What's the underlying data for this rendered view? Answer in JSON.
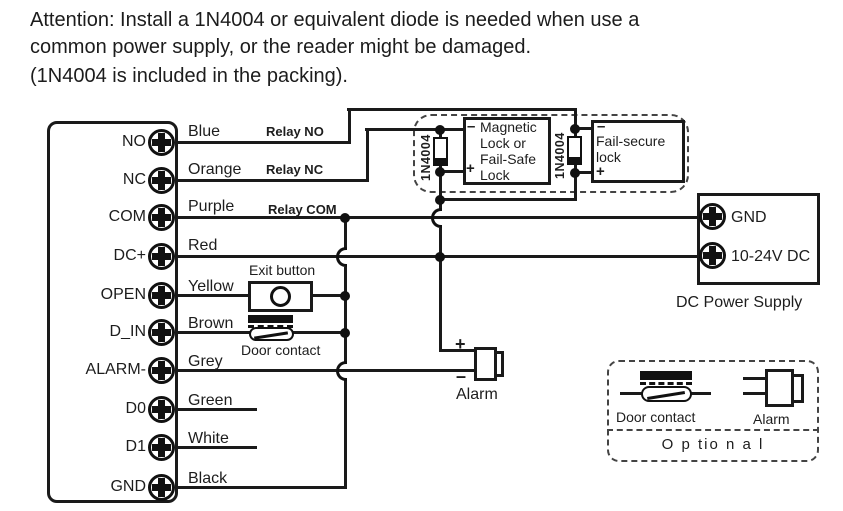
{
  "attention": {
    "line1": "Attention: Install a 1N4004 or equivalent diode is needed when use  a",
    "line2": "common power supply, or the reader might be damaged.",
    "line3": "(1N4004 is included in the packing)."
  },
  "reader": {
    "terminals": [
      {
        "label": "NO",
        "wire": "Blue",
        "relay": "Relay NO"
      },
      {
        "label": "NC",
        "wire": "Orange",
        "relay": "Relay NC"
      },
      {
        "label": "COM",
        "wire": "Purple",
        "relay": "Relay COM"
      },
      {
        "label": "DC+",
        "wire": "Red"
      },
      {
        "label": "OPEN",
        "wire": "Yellow"
      },
      {
        "label": "D_IN",
        "wire": "Brown"
      },
      {
        "label": "ALARM-",
        "wire": "Grey"
      },
      {
        "label": "D0",
        "wire": "Green"
      },
      {
        "label": "D1",
        "wire": "White"
      },
      {
        "label": "GND",
        "wire": "Black"
      }
    ]
  },
  "locks": {
    "diode1": "1N4004",
    "diode2": "1N4004",
    "magnetic": {
      "minus": "–",
      "plus": "+",
      "line1": "Magnetic",
      "line2": "Lock or",
      "line3": "Fail-Safe",
      "line4": "Lock"
    },
    "fail_secure": {
      "minus": "–",
      "plus": "+",
      "line1": "Fail-secure",
      "line2": "lock"
    }
  },
  "exit_button": {
    "label": "Exit button"
  },
  "door_contact": {
    "label": "Door contact"
  },
  "alarm": {
    "label": "Alarm",
    "plus": "+",
    "minus": "–"
  },
  "power_supply": {
    "terminal1": "GND",
    "terminal2": "10-24V DC",
    "label": "DC Power Supply"
  },
  "optional": {
    "door_contact": "Door contact",
    "alarm": "Alarm",
    "label": "O p tio n a l"
  }
}
